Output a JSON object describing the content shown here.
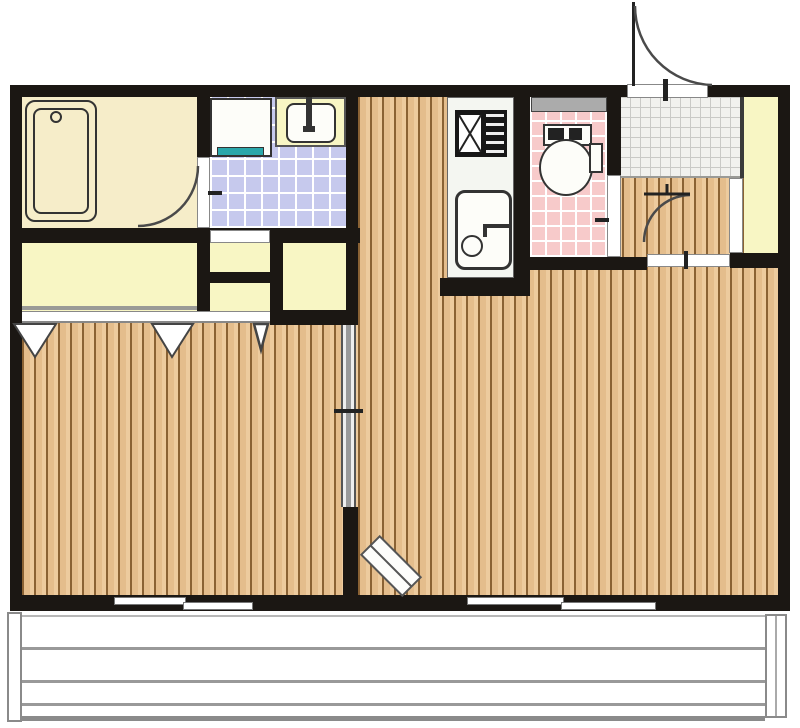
{
  "palette": {
    "wall": "#1b1713",
    "wood": "#e4bd8c",
    "wood_line": "#8a6234",
    "wood_hi": "#edcb9e",
    "bathroom": "#f6edc9",
    "closet": "#f8f6c4",
    "lavender": "#c6c9ed",
    "pink": "#f7caca",
    "teal": "#2aa7ab",
    "counter": "#f4f6f1",
    "genkan": "#f1f1ee",
    "genkan_line": "#c9c9c6",
    "window_gray": "#ababab",
    "rail": "#999999",
    "fixture_line": "#333333",
    "arc": "#4a4a4a"
  },
  "floor_plan": {
    "type": "apartment-floor-plan",
    "rooms": [
      "bathroom",
      "washroom",
      "kitchen",
      "toilet",
      "entrance-genkan",
      "hallway",
      "shoe-cabinet",
      "closet-left",
      "closet-middle-upper",
      "closet-middle-lower",
      "closet-right",
      "bedroom",
      "living-room",
      "balcony"
    ],
    "fixtures": [
      "bathtub",
      "bathtub-drain",
      "washing-machine-pan",
      "vanity-sink",
      "vanity-faucet",
      "gas-stove",
      "kitchen-sink",
      "sink-faucet",
      "toilet-tank",
      "toilet-bowl",
      "toilet-window",
      "entry-door-swing",
      "bathroom-door-swing",
      "hallway-door-swing",
      "toilet-door",
      "washroom-door",
      "sliding-partition-door",
      "open-door-leaf",
      "closet-fold-marks",
      "window-left",
      "window-right",
      "balcony-railing"
    ]
  }
}
